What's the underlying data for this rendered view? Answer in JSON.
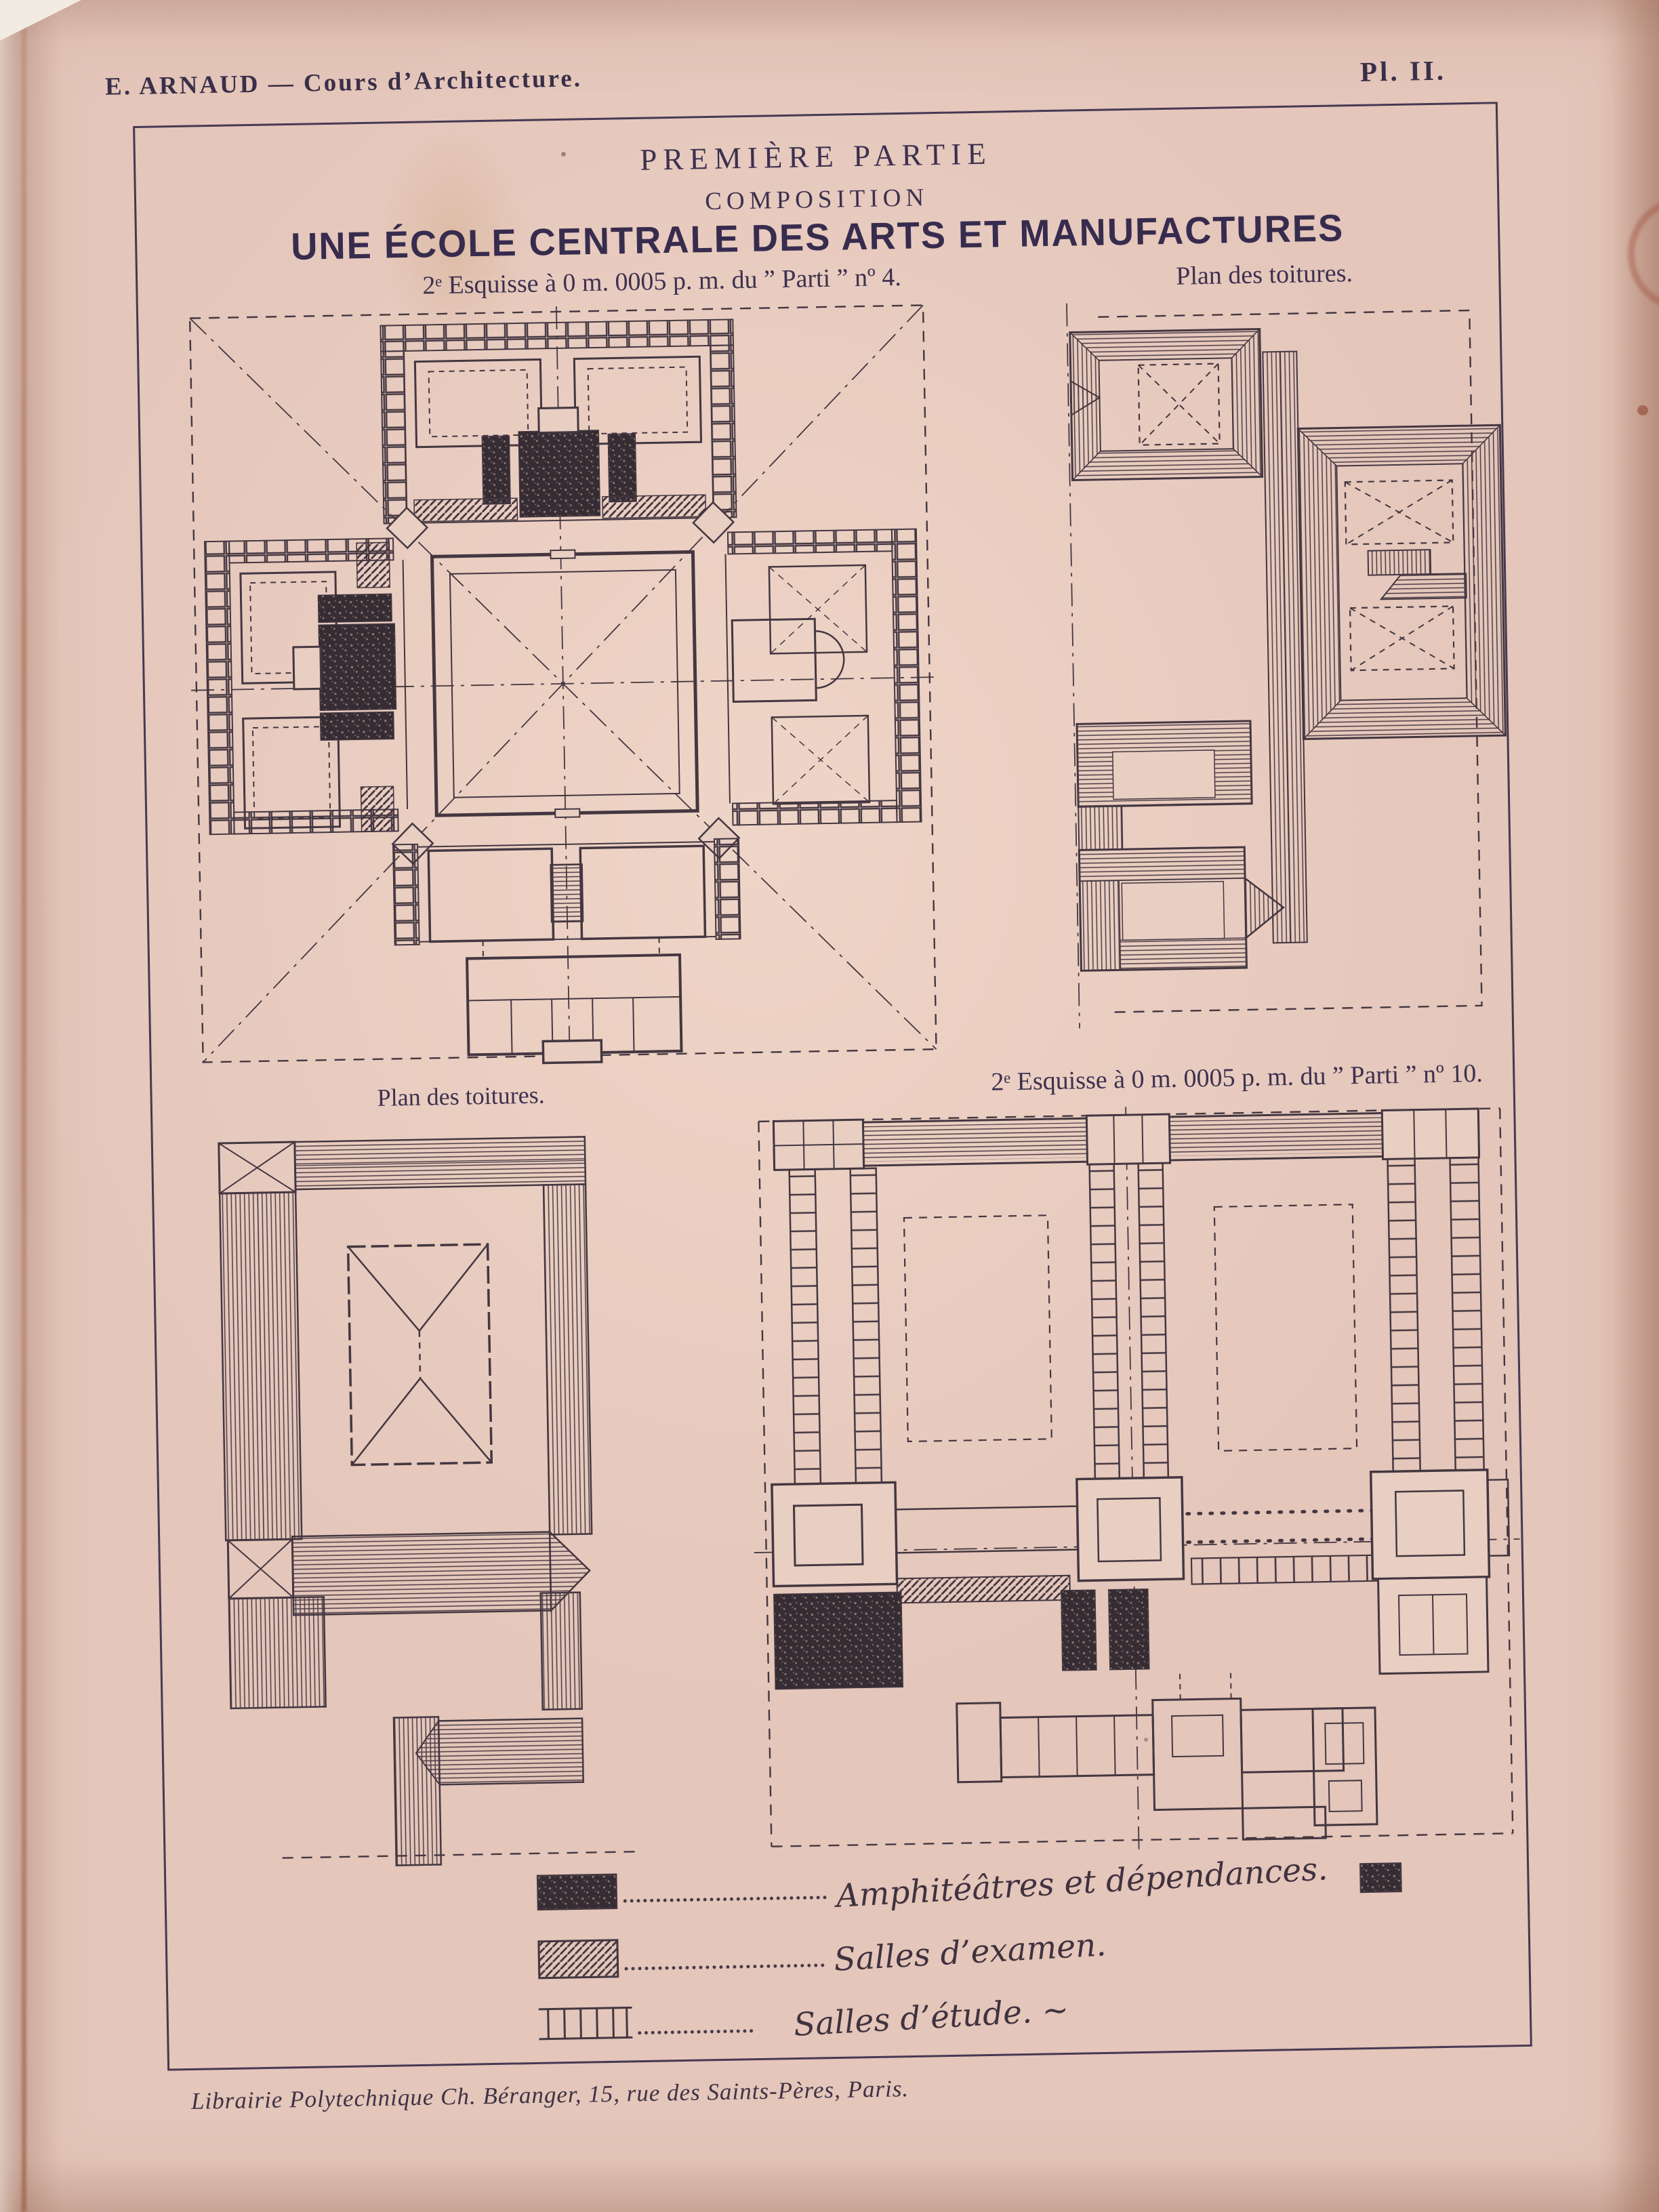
{
  "plate": {
    "running_head": {
      "author_title": "E. ARNAUD  —  Cours d’Architecture.",
      "plate_number": "Pl. II."
    },
    "heading": {
      "part": "PREMIÈRE PARTIE",
      "subsection": "COMPOSITION",
      "title": "UNE ÉCOLE CENTRALE DES ARTS ET MANUFACTURES"
    },
    "drawings": [
      {
        "id": "floor-plan-parti-4",
        "caption": "2ᵉ Esquisse à 0 m. 0005 p. m. du ” Parti ” nº 4."
      },
      {
        "id": "roof-plan-top",
        "caption": "Plan des toitures."
      },
      {
        "id": "roof-plan-bottom",
        "caption": "Plan des toitures."
      },
      {
        "id": "floor-plan-parti-10",
        "caption": "2ᵉ Esquisse à 0 m. 0005 p. m. du ” Parti ” nº 10."
      }
    ],
    "legend": {
      "items": [
        {
          "pattern": "dark-stipple",
          "label": "Amphitéâtres et dépendances."
        },
        {
          "pattern": "diagonal-hatch",
          "label": "Salles d’examen."
        },
        {
          "pattern": "pier-wall",
          "label": "Salles d’étude. ~"
        }
      ]
    },
    "imprint": "Librairie Polytechnique Ch. Béranger, 15, rue des Saints-Pères, Paris.",
    "colors": {
      "paper": "#e4c6ba",
      "ink": "#443741",
      "text_ink": "#3c3050",
      "frame": "#473952"
    }
  }
}
